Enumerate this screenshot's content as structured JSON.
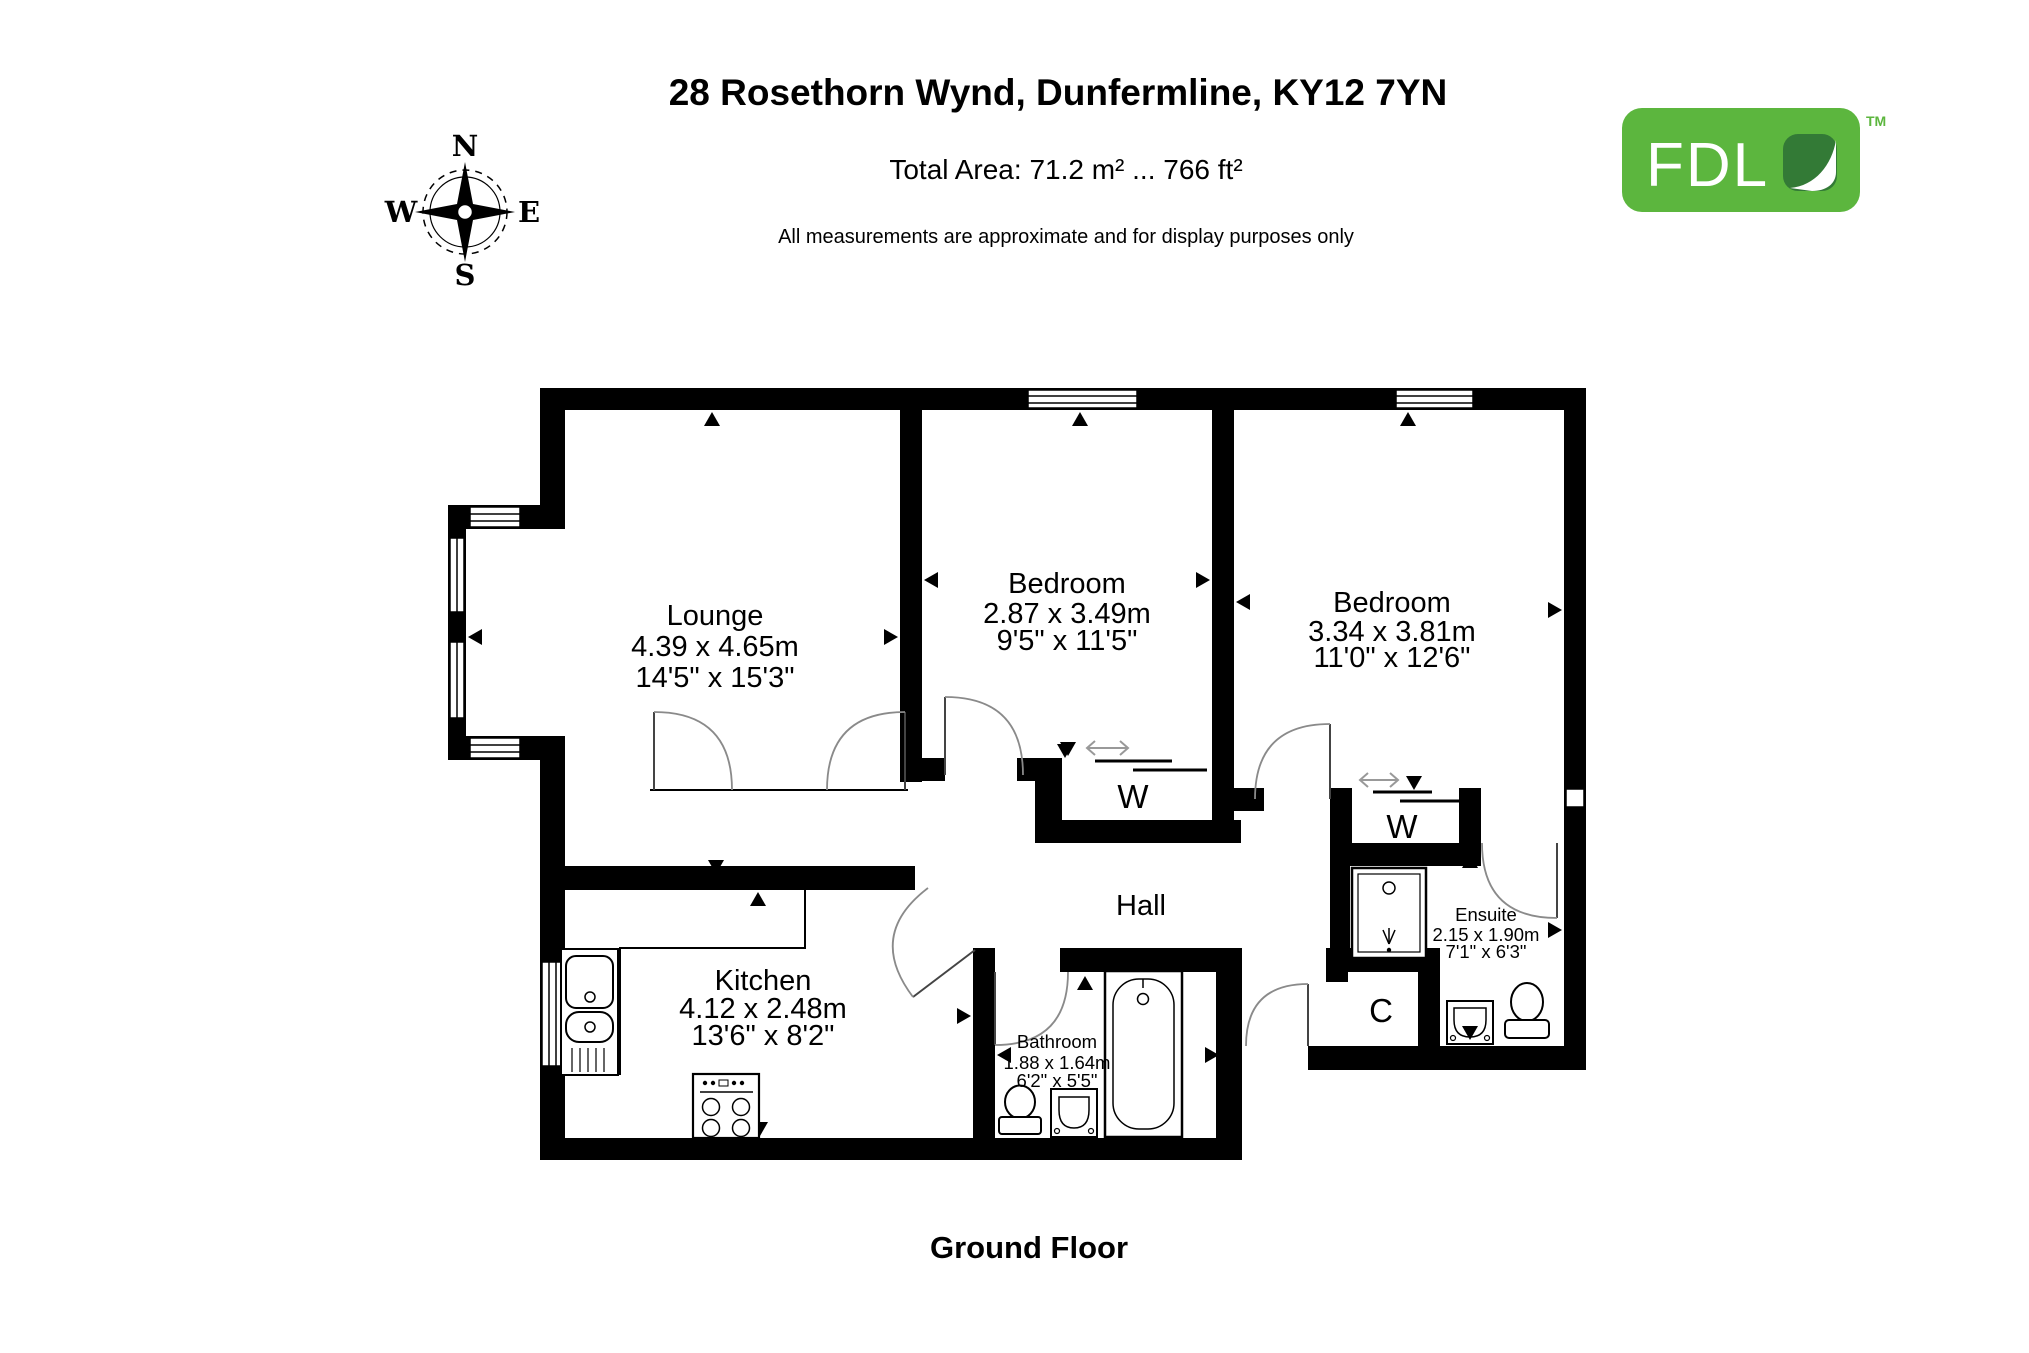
{
  "colors": {
    "wall": "#000000",
    "arc": "#8a8a8a",
    "slide": "#999999",
    "logo_green": "#5cb63e",
    "logo_leaf": "#337a36"
  },
  "header": {
    "title": "28 Rosethorn Wynd, Dunfermline, KY12 7YN",
    "total_area": "Total Area: 71.2 m² ... 766 ft²",
    "disclaimer": "All measurements are approximate and for display purposes only"
  },
  "footer": {
    "floor_label": "Ground Floor"
  },
  "logo": {
    "text": "FDL",
    "tm": "TM"
  },
  "compass": {
    "north": "N",
    "east": "E",
    "south": "S",
    "west": "W"
  },
  "rooms": [
    {
      "name": "Lounge",
      "metric": "4.39 x 4.65m",
      "imperial": "14'5\" x 15'3\""
    },
    {
      "name": "Bedroom",
      "metric": "2.87 x 3.49m",
      "imperial": "9'5\" x 11'5\""
    },
    {
      "name": "Bedroom",
      "metric": "3.34 x 3.81m",
      "imperial": "11'0\" x 12'6\""
    },
    {
      "name": "Kitchen",
      "metric": "4.12 x 2.48m",
      "imperial": "13'6\" x 8'2\""
    },
    {
      "name": "Bathroom",
      "metric": "1.88 x 1.64m",
      "imperial": "6'2\" x 5'5\""
    },
    {
      "name": "Ensuite",
      "metric": "2.15 x 1.90m",
      "imperial": "7'1\" x 6'3\""
    }
  ],
  "labels": {
    "hall": "Hall",
    "wardrobe": "W",
    "cupboard": "C"
  }
}
